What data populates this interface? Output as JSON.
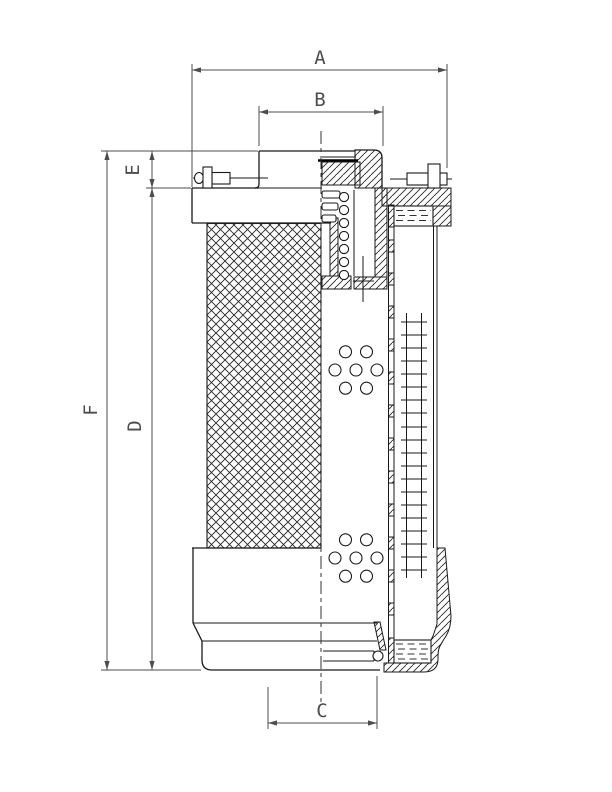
{
  "drawing": {
    "background": "#ffffff",
    "object_line_color": "#1a1a1a",
    "dimension_line_color": "#4d4d4d",
    "dimensions": [
      {
        "label": "A",
        "axis": "horizontal",
        "location": "top-outer"
      },
      {
        "label": "B",
        "axis": "horizontal",
        "location": "top-inner"
      },
      {
        "label": "C",
        "axis": "horizontal",
        "location": "bottom"
      },
      {
        "label": "D",
        "axis": "vertical",
        "location": "left-inner"
      },
      {
        "label": "E",
        "axis": "vertical",
        "location": "left-upper"
      },
      {
        "label": "F",
        "axis": "vertical",
        "location": "left-outer"
      }
    ]
  }
}
